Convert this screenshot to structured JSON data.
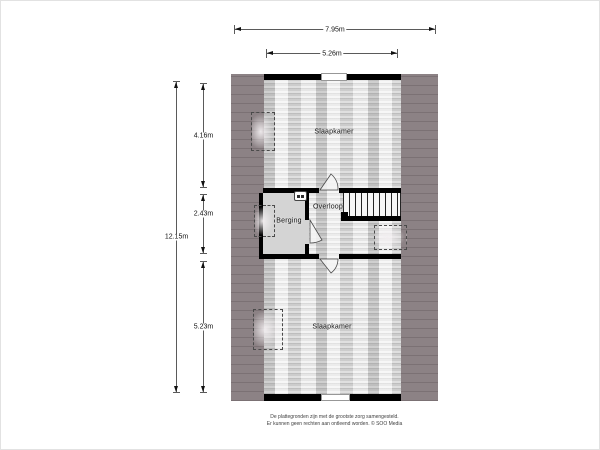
{
  "rooms": {
    "bedroom_top": "Slaapkamer",
    "landing": "Overloop",
    "storage": "Berging",
    "bedroom_bottom": "Slaapkamer"
  },
  "dimensions": {
    "total_width": "7.95m",
    "inner_width": "5.26m",
    "total_height": "12.15m",
    "top_height": "4.16m",
    "middle_height": "2.43m",
    "bottom_height": "5.23m"
  },
  "disclaimer": {
    "line1": "De plattegronden zijn met de grootste zorg samengesteld.",
    "line2": "Er kunnen geen rechten aan ontleend worden. © SOO Media"
  },
  "colors": {
    "roof": "#8c8285",
    "roof_line": "#7b7174",
    "wall": "#000000",
    "floor_base": "#dedede",
    "storage_floor": "#d4d4d4"
  },
  "icons": {
    "boiler": "boiler-icon",
    "door": "door-swing-icon",
    "skylight": "skylight-marker",
    "stairs": "stairs"
  }
}
